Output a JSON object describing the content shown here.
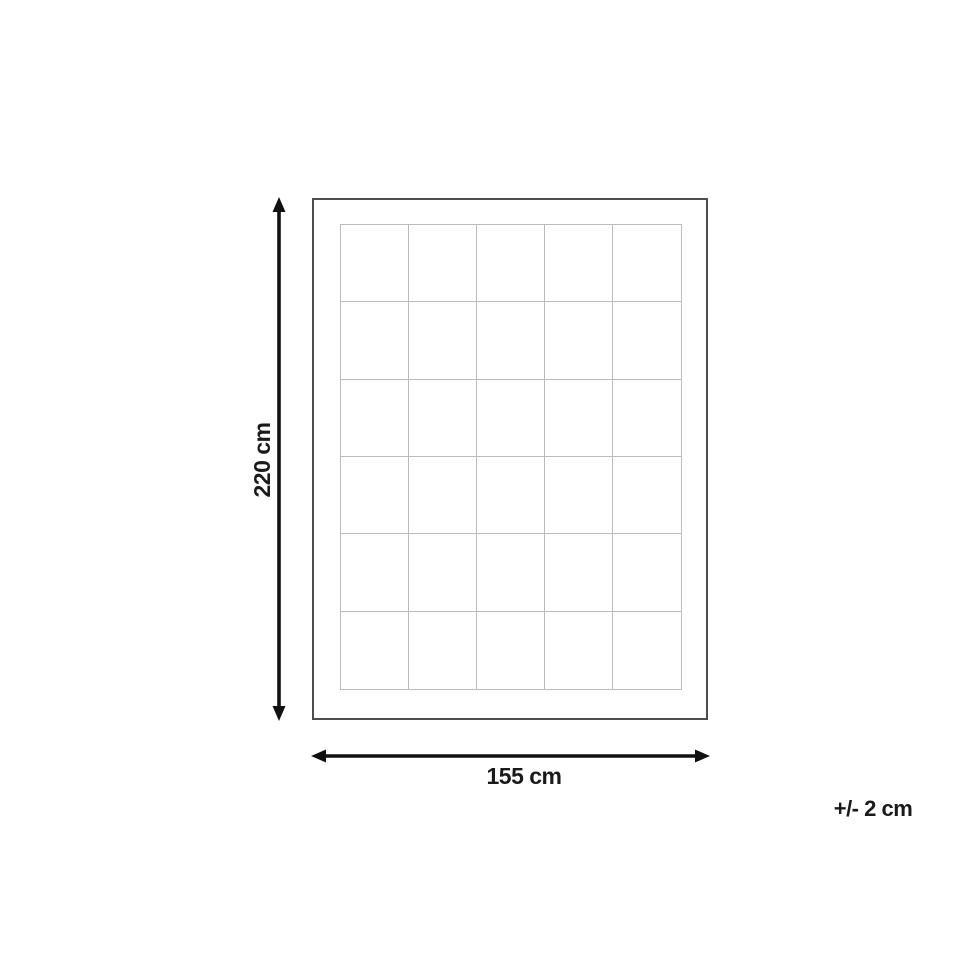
{
  "diagram": {
    "vertical_dimension": {
      "label": "220 cm"
    },
    "horizontal_dimension": {
      "label": "155 cm"
    },
    "tolerance": {
      "label": "+/- 2 cm"
    },
    "grid": {
      "columns": 5,
      "rows": 6
    },
    "colors": {
      "background": "#ffffff",
      "outline": "#4d4d4d",
      "grid_line": "#bcbcbc",
      "arrow": "#111111",
      "text": "#1a1a1a"
    }
  }
}
